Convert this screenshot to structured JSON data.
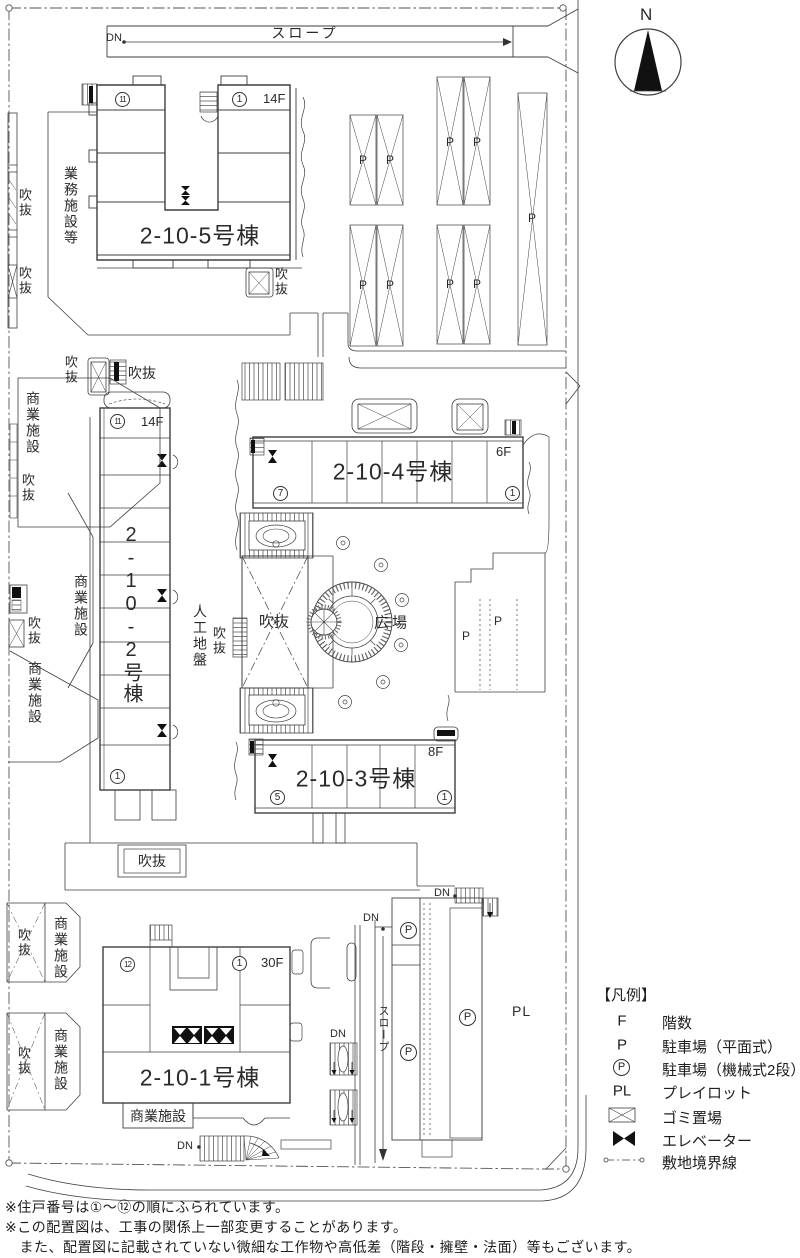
{
  "compass": {
    "north": "N"
  },
  "labels": {
    "dn": "DN",
    "slope": "スロープ",
    "p": "P",
    "pl": "PL",
    "fukinuke": "吹抜",
    "hiroba": "広場",
    "shogyo": "商業施設",
    "gyomu": "業務施設等",
    "jinko_jiban": "人工地盤"
  },
  "buildings": {
    "b5": {
      "name": "2-10-5号棟",
      "floors": "14F",
      "unit_a": "11",
      "unit_b": "1"
    },
    "b2": {
      "name": "2-10-2号棟",
      "floors": "14F",
      "unit_a": "11",
      "unit_b": "1"
    },
    "b4": {
      "name": "2-10-4号棟",
      "floors": "6F",
      "unit_a": "7",
      "unit_b": "1"
    },
    "b3": {
      "name": "2-10-3号棟",
      "floors": "8F",
      "unit_a": "5",
      "unit_b": "1"
    },
    "b1": {
      "name": "2-10-1号棟",
      "floors": "30F",
      "unit_a": "12",
      "unit_b": "1"
    }
  },
  "legend": {
    "title": "【凡例】",
    "items": [
      {
        "sym": "F",
        "label": "階数"
      },
      {
        "sym": "P",
        "label": "駐車場（平面式）"
      },
      {
        "sym": "P",
        "label": "駐車場（機械式2段）"
      },
      {
        "sym": "PL",
        "label": "プレイロット"
      },
      {
        "sym": "",
        "label": "ゴミ置場"
      },
      {
        "sym": "",
        "label": "エレベーター"
      },
      {
        "sym": "",
        "label": "敷地境界線"
      }
    ]
  },
  "notes": [
    "※住戸番号は①～⑫の順にふられています。",
    "※この配置図は、工事の関係上一部変更することがあります。",
    "　また、配置図に記載されていない微細な工作物や高低差（階段・擁壁・法面）等もございます。"
  ]
}
